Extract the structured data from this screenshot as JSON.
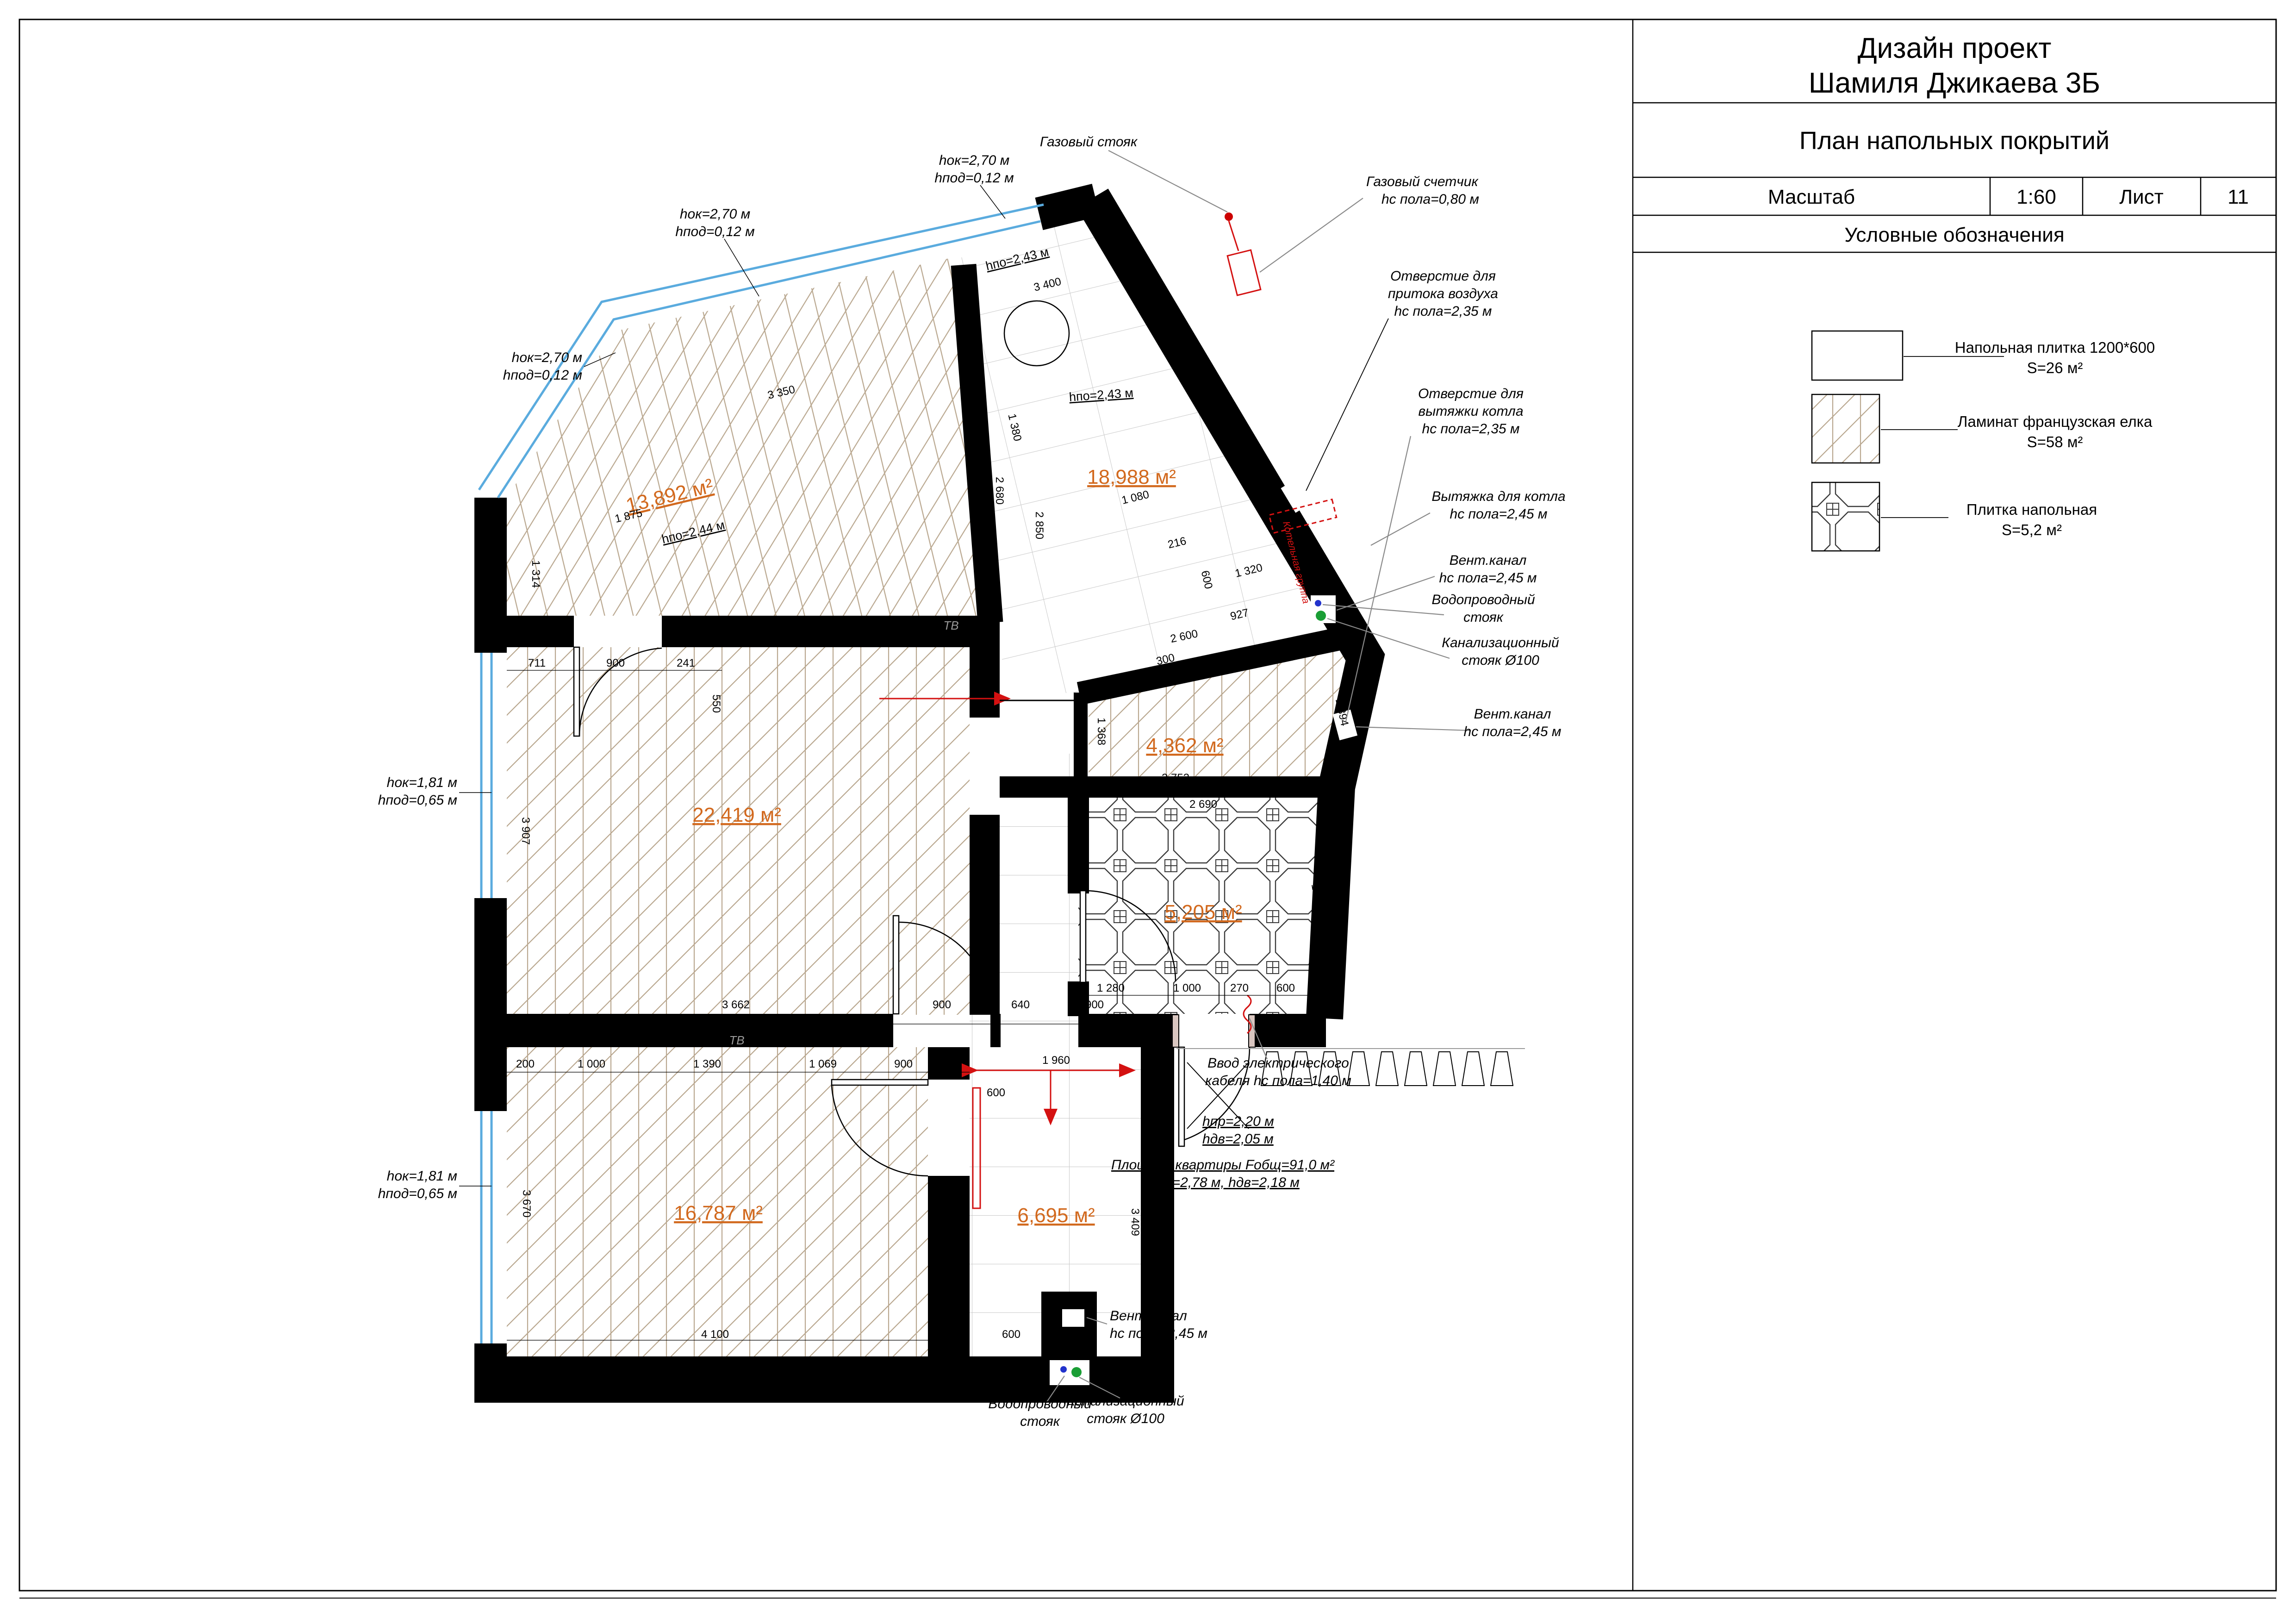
{
  "sheet": {
    "project_line1": "Дизайн проект",
    "project_line2": "Шамиля Джикаева 3Б",
    "drawing_title": "План напольных покрытий",
    "scale_label": "Масштаб",
    "scale_value": "1:60",
    "sheet_label": "Лист",
    "sheet_number": "11",
    "legend_title": "Условные обозначения"
  },
  "legend": {
    "tile_name": "Напольная плитка 1200*600",
    "tile_area": "S=26 м²",
    "laminate_name": "Ламинат французская елка",
    "laminate_area": "S=58 м²",
    "floor_tile_name": "Плитка напольная",
    "floor_tile_area": "S=5,2 м²"
  },
  "rooms": {
    "kitchen_area": "13,892 м²",
    "hall_top_area": "18,988 м²",
    "living_area": "22,419 м²",
    "hall_area": "4,362 м²",
    "vestibule_area": "5,205 м²",
    "bedroom_area": "16,787 м²",
    "corridor_area": "6,695 м²",
    "kitchen_height": "hпо=2,44 м",
    "hall_top_height": "hпо=2,43 м",
    "hall_top_height2": "hпо=2,43 м",
    "tv": "ТВ"
  },
  "ann": {
    "wl1": [
      "hок=1,81 м",
      "hпод=0,65 м"
    ],
    "wl2": [
      "hок=1,81 м",
      "hпод=0,65 м"
    ],
    "wt1": [
      "hок=2,70 м",
      "hпод=0,12 м"
    ],
    "wt2": [
      "hок=2,70 м",
      "hпод=0,12 м"
    ],
    "wt3": [
      "hок=2,70 м",
      "hпод=0,12 м"
    ],
    "gas_riser": "Газовый стояк",
    "gas_meter": [
      "Газовый счетчик",
      "hс пола=0,80 м"
    ],
    "air": [
      "Отверстие для",
      "притока воздуха",
      "hс пола=2,35 м"
    ],
    "exh": [
      "Отверстие для",
      "вытяжки котла",
      "hс пола=2,35 м"
    ],
    "hood": [
      "Вытяжка для котла",
      "hс пола=2,45 м"
    ],
    "vent1": [
      "Вент.канал",
      "hс пола=2,45 м"
    ],
    "water1": [
      "Водопроводный",
      "стояк"
    ],
    "sewer1": [
      "Канализационный",
      "стояк Ø100"
    ],
    "vent2": [
      "Вент.канал",
      "hс пола=2,45 м"
    ],
    "cable": [
      "Ввод электрического",
      "кабеля hс пола=1,40 м"
    ],
    "entry": [
      "hпр=2,20 м",
      "hдв=2,05 м"
    ],
    "apt": [
      "Площадь квартиры Fобщ=91,0 м²",
      "hэт=2,78 м, hдв=2,18 м"
    ],
    "vent3": [
      "Вент.канал",
      "hс пола=2,45 м"
    ],
    "water2": [
      "Водопроводный",
      "стояк"
    ],
    "sewer2": [
      "Канализационный",
      "стояк Ø100"
    ],
    "boiler": "Котельная группа"
  },
  "dims": [
    "3 350",
    "3 400",
    "1 380",
    "1 080",
    "216",
    "600",
    "927",
    "300",
    "2 680",
    "2 850",
    "1 320",
    "1 160",
    "711",
    "900",
    "241",
    "550",
    "2 500",
    "3 907",
    "3 662",
    "900",
    "640",
    "900",
    "2 600",
    "2 752",
    "1 368",
    "1 894",
    "2 690",
    "1 280",
    "1 000",
    "270",
    "600",
    "1 800",
    "200",
    "1 000",
    "1 390",
    "1 069",
    "900",
    "600",
    "3 670",
    "2 500",
    "4 100",
    "600",
    "1 960",
    "3 409",
    "1 875",
    "1 314"
  ],
  "colors": {
    "wall": "#000000",
    "window": "#5aabde",
    "room_label": "#d2691e",
    "red": "#d41111",
    "sewer_green": "#1a9e35",
    "water_blue": "#2233cc",
    "wood": "#b9a78f",
    "tile_grid": "#c9c9c9"
  }
}
